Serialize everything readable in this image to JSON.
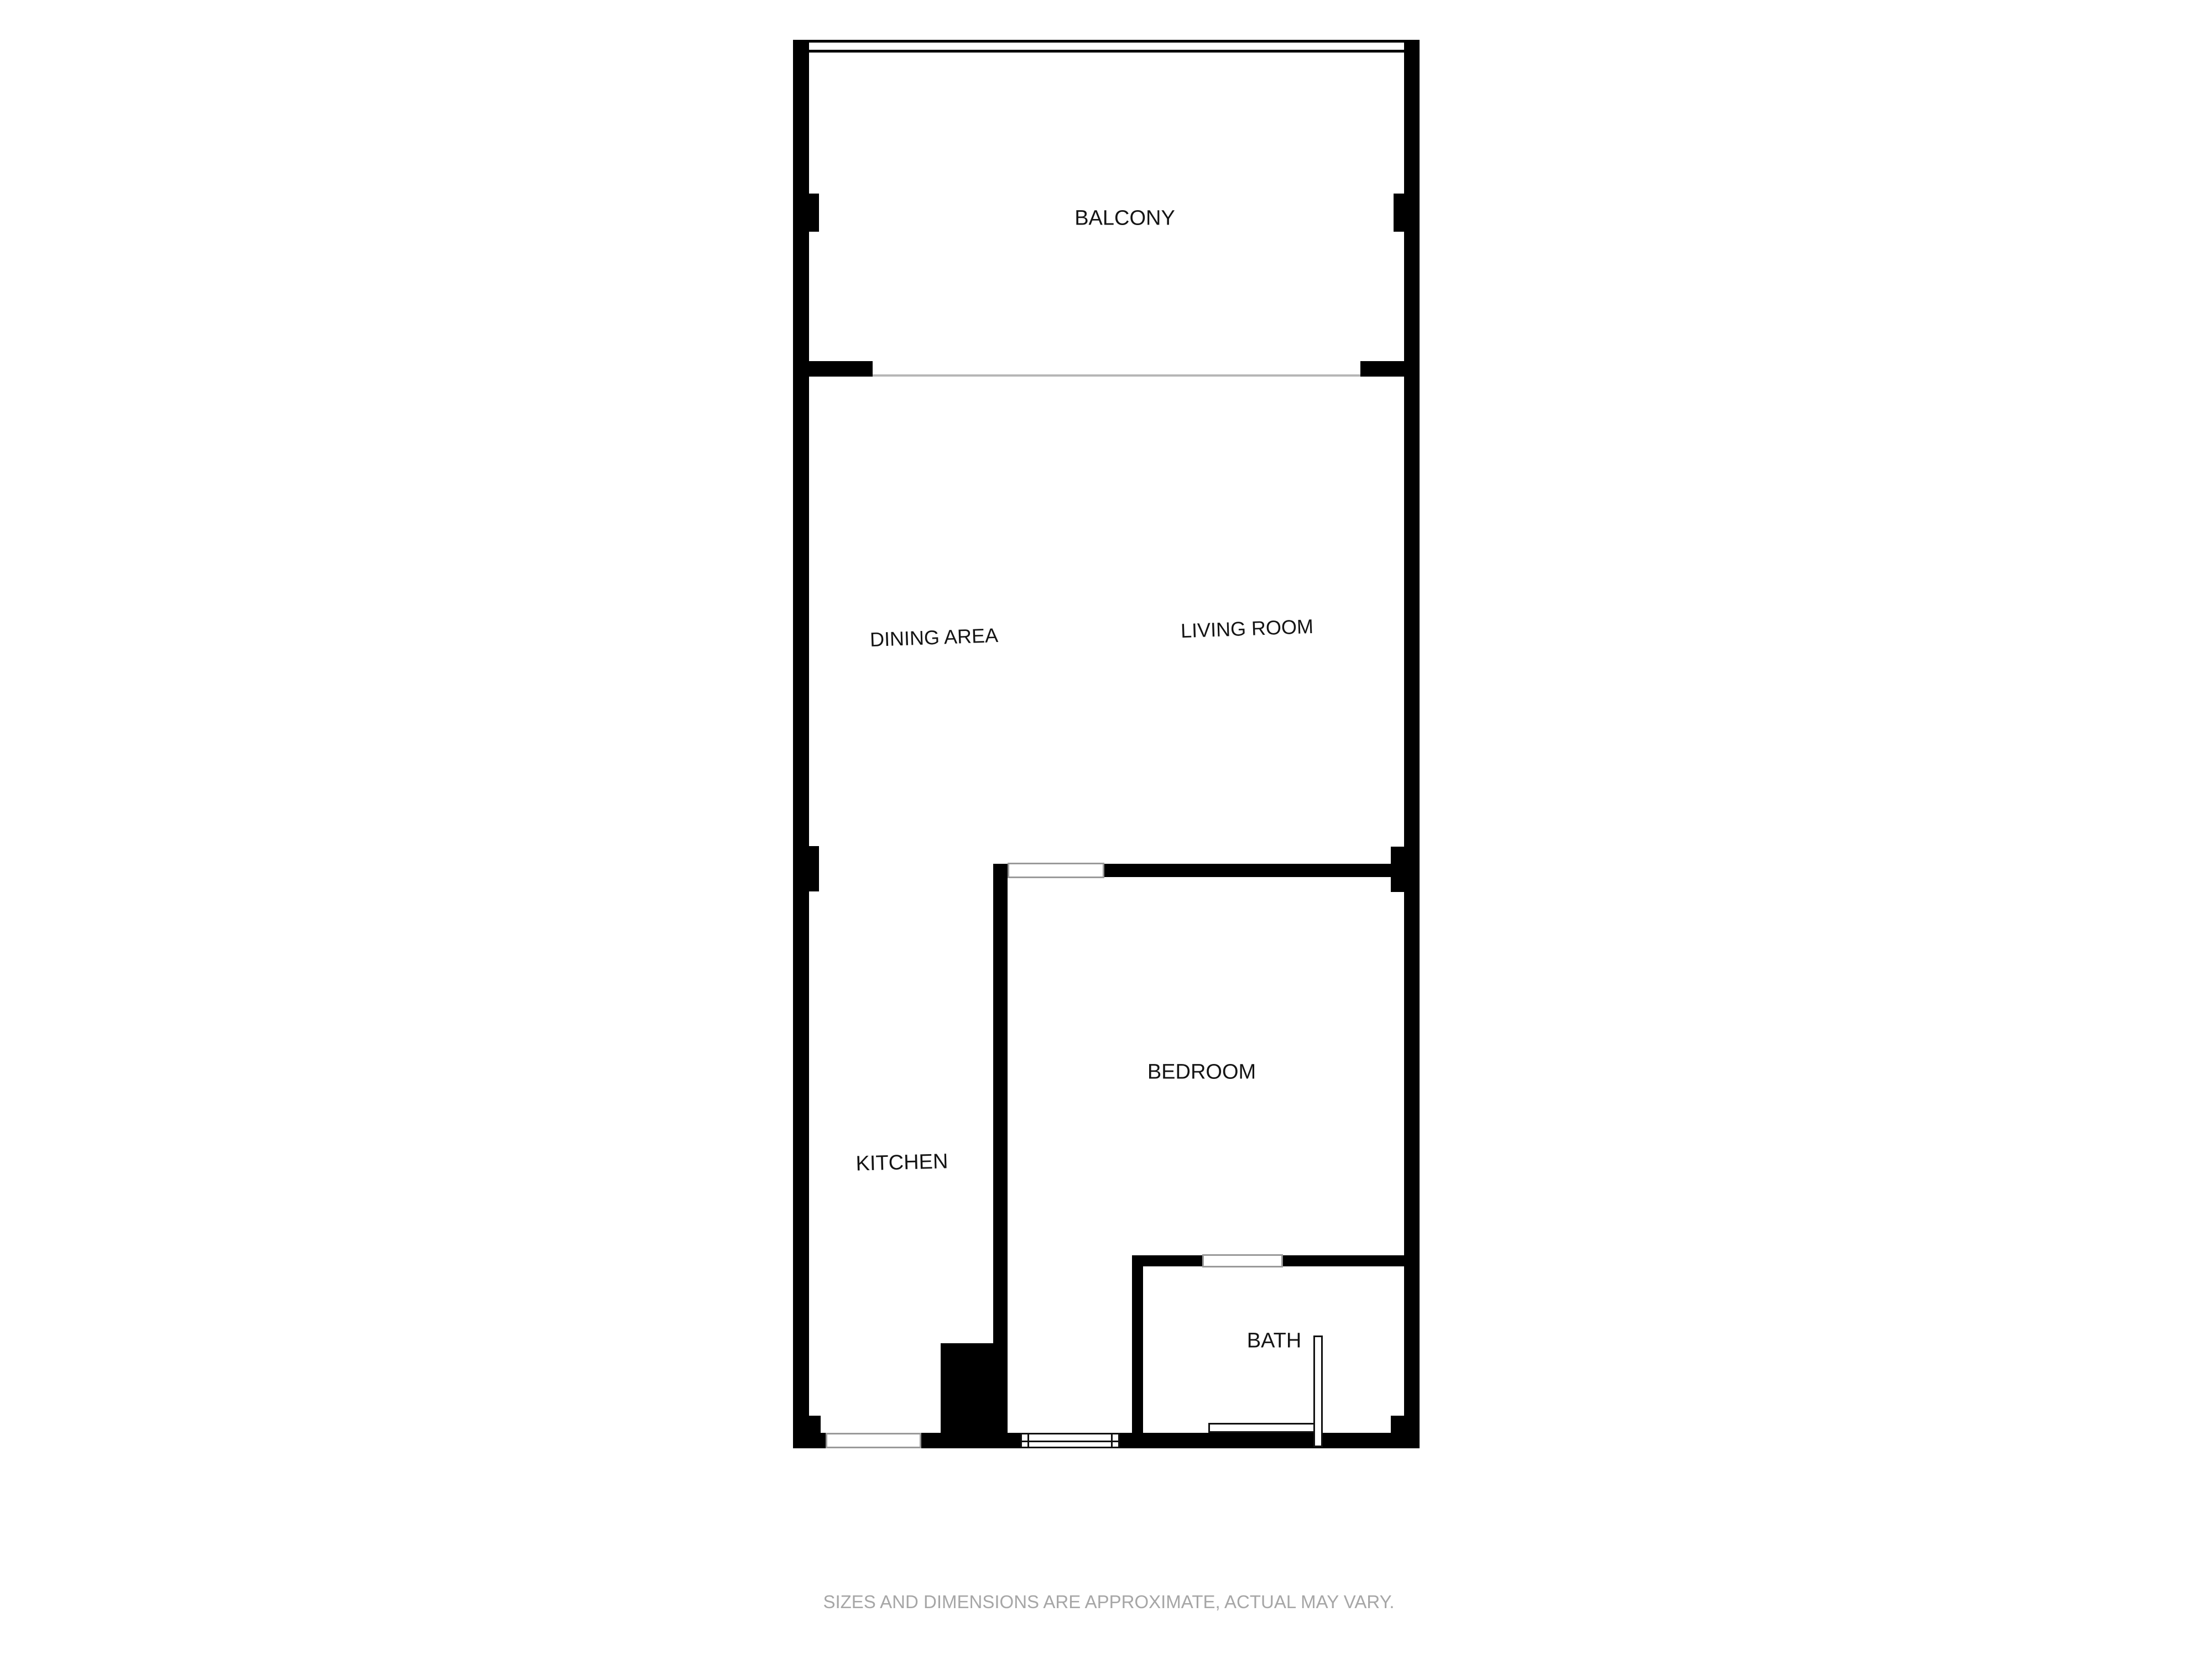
{
  "rooms": {
    "balcony": "BALCONY",
    "dining_area": "DINING AREA",
    "living_room": "LIVING ROOM",
    "kitchen": "KITCHEN",
    "bedroom": "BEDROOM",
    "bath": "BATH"
  },
  "disclaimer": "SIZES AND DIMENSIONS ARE APPROXIMATE, ACTUAL MAY VARY.",
  "colors": {
    "background": "#ffffff",
    "wall": "#000000",
    "window_outline": "#9a9a9a",
    "sliding_door_line": "#b6b6b6",
    "door_outline": "#111111",
    "label_text": "#141414",
    "disclaimer_text": "#a6a6a6"
  }
}
